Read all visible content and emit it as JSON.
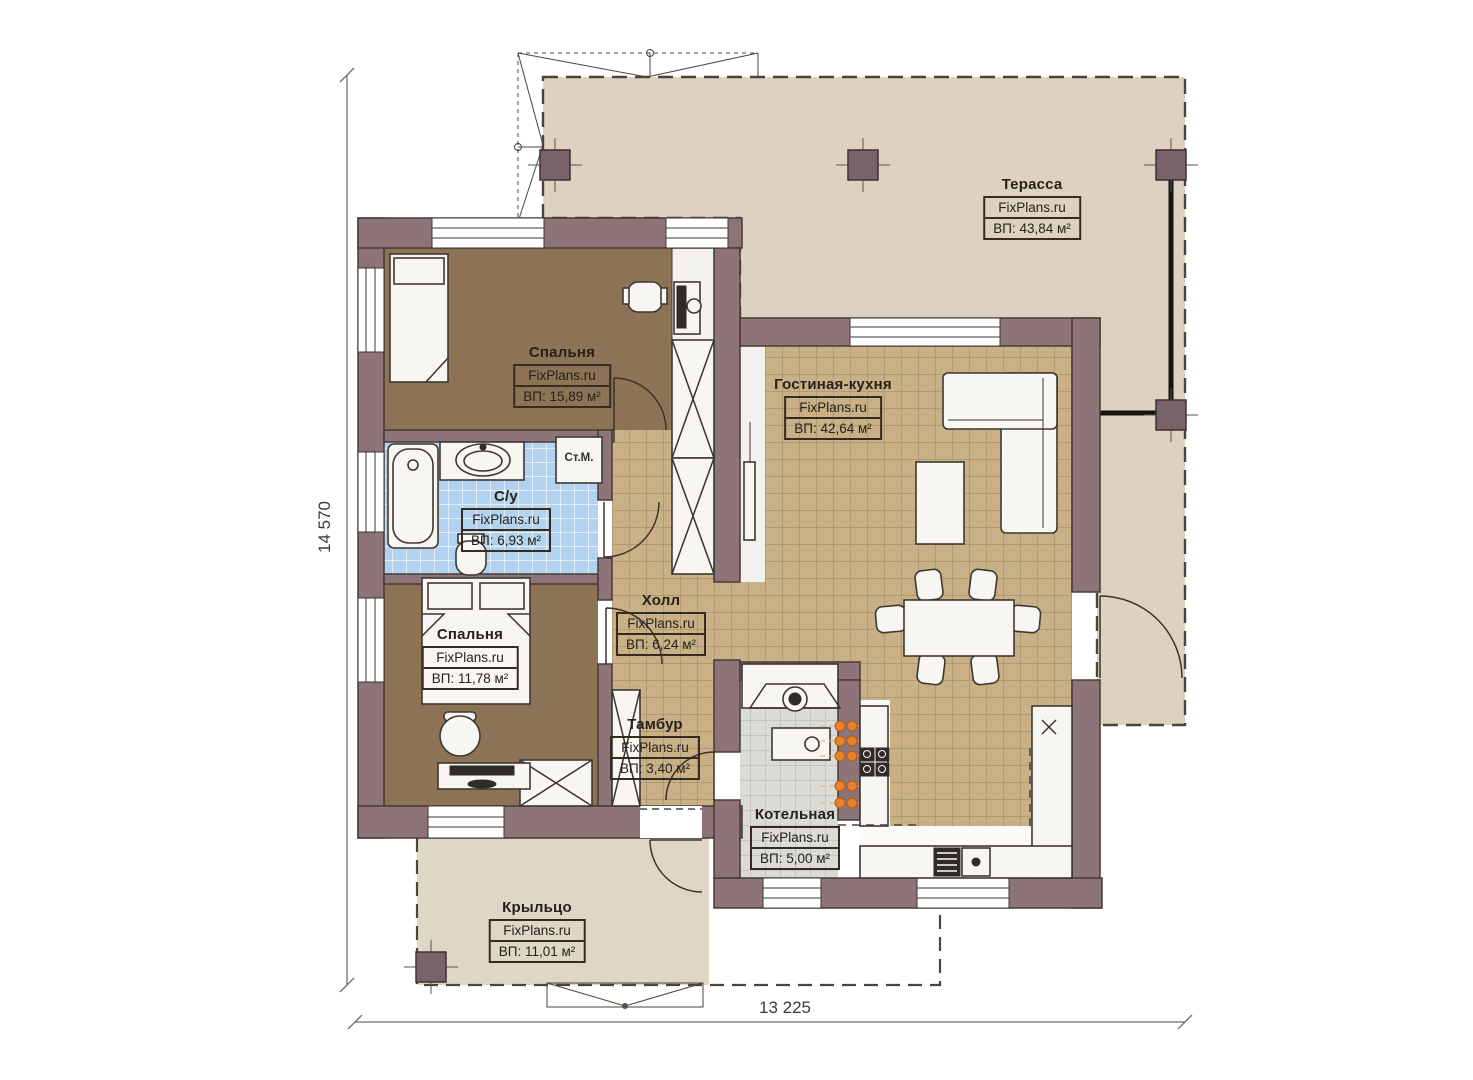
{
  "plan": {
    "source": "FixPlans.ru",
    "rooms": [
      {
        "id": "terrace",
        "name": "Терасса",
        "watermark": "FixPlans.ru",
        "area": "ВП: 43,84 м²"
      },
      {
        "id": "bedroom1",
        "name": "Спальня",
        "watermark": "FixPlans.ru",
        "area": "ВП: 15,89 м²"
      },
      {
        "id": "living-kitchen",
        "name": "Гостиная-кухня",
        "watermark": "FixPlans.ru",
        "area": "ВП: 42,64 м²"
      },
      {
        "id": "bathroom",
        "name": "С/у",
        "watermark": "FixPlans.ru",
        "area": "ВП: 6,93 м²"
      },
      {
        "id": "hall",
        "name": "Холл",
        "watermark": "FixPlans.ru",
        "area": "ВП: 6,24 м²"
      },
      {
        "id": "bedroom2",
        "name": "Спальня",
        "watermark": "FixPlans.ru",
        "area": "ВП: 11,78 м²"
      },
      {
        "id": "vestibule",
        "name": "Тамбур",
        "watermark": "FixPlans.ru",
        "area": "ВП: 3,40 м²"
      },
      {
        "id": "boiler-room",
        "name": "Котельная",
        "watermark": "FixPlans.ru",
        "area": "ВП: 5,00 м²"
      },
      {
        "id": "porch",
        "name": "Крыльцо",
        "watermark": "FixPlans.ru",
        "area": "ВП: 11,01 м²"
      }
    ],
    "annotations": {
      "washing_machine": "Ст.М."
    },
    "dimensions": {
      "vertical": "14 570",
      "horizontal": "13 225"
    },
    "colors": {
      "wall": "#8c7478",
      "terrace": "#ddd2c0",
      "porch": "#e0d6c5",
      "bedroom_floor": "#8c7356",
      "living_tile": "#c9b087",
      "bath_tile": "#b2d3f0",
      "boiler_tile": "#dbdbd7",
      "radiator": "#e8812f"
    }
  }
}
